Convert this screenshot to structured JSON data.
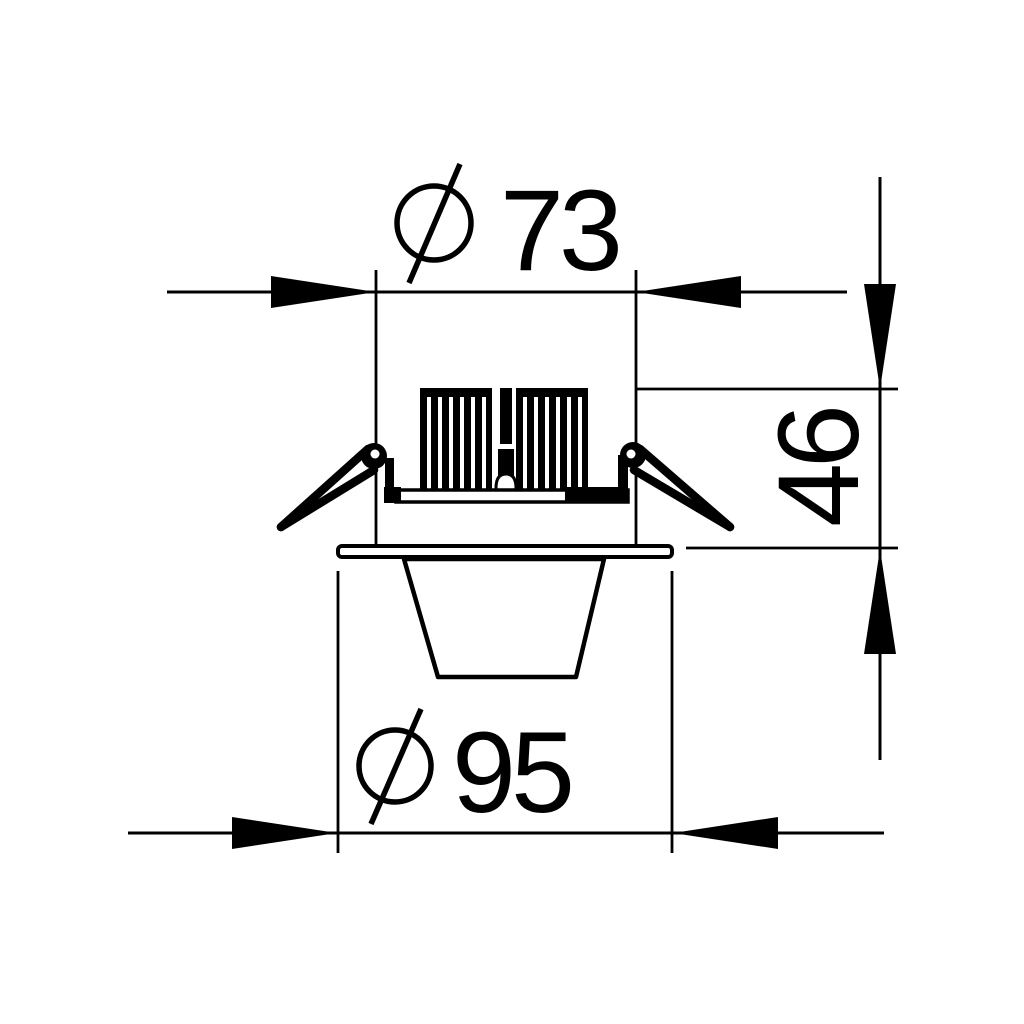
{
  "drawing": {
    "dimensions": {
      "top": {
        "symbol": "⌀",
        "value": "73"
      },
      "right": {
        "value": "46"
      },
      "bottom": {
        "symbol": "⌀",
        "value": "95"
      }
    },
    "colors": {
      "line": "#000000",
      "background": "#ffffff"
    }
  }
}
